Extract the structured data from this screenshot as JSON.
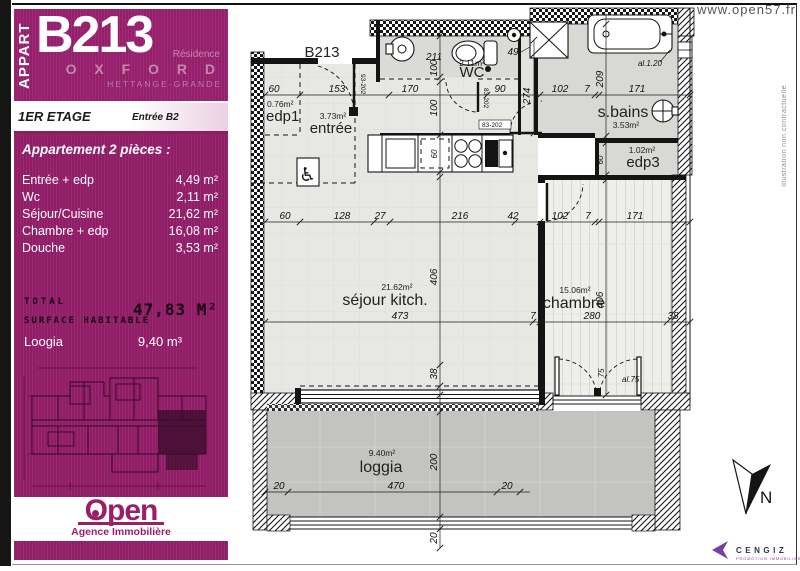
{
  "sidebar": {
    "appart_label": "APPART",
    "unit": "B213",
    "residence_label": "Résidence",
    "residence_name": "O X F O R D",
    "residence_city": "HETTANGE-GRANDE",
    "floor": "1ER ETAGE",
    "entrance": "Entrée B2",
    "heading": "Appartement 2 pièces :",
    "rooms": [
      {
        "label": "Entrée + edp",
        "area": "4,49 m²"
      },
      {
        "label": "Wc",
        "area": "2,11 m²"
      },
      {
        "label": "Séjour/Cuisine",
        "area": "21,62 m²"
      },
      {
        "label": "Chambre + edp",
        "area": "16,08 m²"
      },
      {
        "label": "Douche",
        "area": "3,53 m²"
      }
    ],
    "total_line1": "TOTAL",
    "total_line2": "SURFACE HABITABLE",
    "total_value": "47,83 M²",
    "loggia_label": "Loogia",
    "loggia_value": "9,40 m³",
    "agency_name": "Open",
    "agency_tagline": "Agence Immobilière"
  },
  "plan": {
    "unit_label": "B213",
    "url": "www.open57.fr",
    "note": "illustration non contractuelle",
    "north": "N",
    "rooms": {
      "edp1": {
        "area": "0.76m²",
        "name": "edp1"
      },
      "entree": {
        "area": "3.73m²",
        "name": "entrée"
      },
      "wc": {
        "area": "2.11m²",
        "name": "WC"
      },
      "sbains": {
        "name": "s.bains",
        "area": "3.53m²"
      },
      "edp3": {
        "area": "1.02m²",
        "name": "edp3"
      },
      "sejour": {
        "area": "21.62m²",
        "name": "séjour kitch."
      },
      "chambre": {
        "area": "15.06m²",
        "name": "chambre"
      },
      "loggia": {
        "area": "9.40m²",
        "name": "loggia"
      }
    },
    "dims": {
      "row1": [
        "60",
        "153",
        "170",
        "90",
        "102",
        "7",
        "171"
      ],
      "row2": [
        "60",
        "128",
        "27",
        "216",
        "42",
        "102",
        "7",
        "171"
      ],
      "row3": [
        "473",
        "7",
        "280",
        "38"
      ],
      "loggia_row": [
        "20",
        "470",
        "20"
      ],
      "left_chain": [
        "100",
        "100",
        "60",
        "406",
        "38",
        "200",
        "20"
      ],
      "right_chain": [
        "209",
        "60",
        "406",
        "75"
      ],
      "wc_width": "211",
      "corridor": "274",
      "shower": "49",
      "bath_note": "al.1.20",
      "door_note": "al.75"
    },
    "doors": {
      "entrance": "93-202",
      "wc": "83-202",
      "hall": "83-202"
    }
  },
  "branding": {
    "cengiz": "CENGIZ",
    "cengiz_sub": "PROMOTION IMMOBILIERE"
  }
}
